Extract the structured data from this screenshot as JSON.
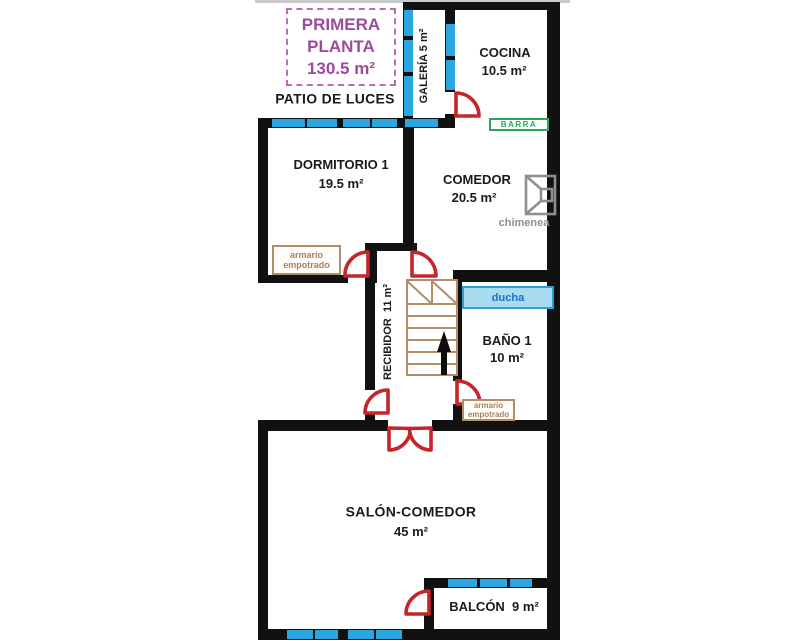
{
  "plan": {
    "title": {
      "line1": "PRIMERA",
      "line2": "PLANTA",
      "area": "130.5 m²"
    },
    "patio_label": "PATIO DE LUCES",
    "rooms": {
      "galeria": {
        "label": "GALERÍA 5 m²"
      },
      "cocina": {
        "name": "COCINA",
        "area": "10.5 m²"
      },
      "dormitorio1": {
        "name": "DORMITORIO 1",
        "area": "19.5 m²"
      },
      "comedor": {
        "name": "COMEDOR",
        "area": "20.5 m²"
      },
      "recibidor": {
        "label": "RECIBIDOR  11 m²"
      },
      "bano1": {
        "name": "BAÑO 1",
        "area": "10 m²"
      },
      "salon": {
        "name": "SALÓN-COMEDOR",
        "area": "45 m²"
      },
      "balcon": {
        "label": "BALCÓN  9 m²"
      }
    },
    "features": {
      "barra": "BARRA",
      "ducha": "ducha",
      "chimenea": "chimenea",
      "armario": "armario empotrado"
    },
    "colors": {
      "wall": "#111111",
      "window": "#2CA6E0",
      "door": "#C4262A",
      "title": "#9C4A9C",
      "title_border": "#BA6CBA",
      "barra": "#2FA45C",
      "ducha_text": "#1B6FD0",
      "ducha_fill": "#A9DBF1",
      "ducha_border": "#2E9FD4",
      "wood": "#B28E66",
      "armario_text": "#A9805E",
      "chimenea": "#8F8F8F",
      "label": "#1A1A1A"
    }
  }
}
